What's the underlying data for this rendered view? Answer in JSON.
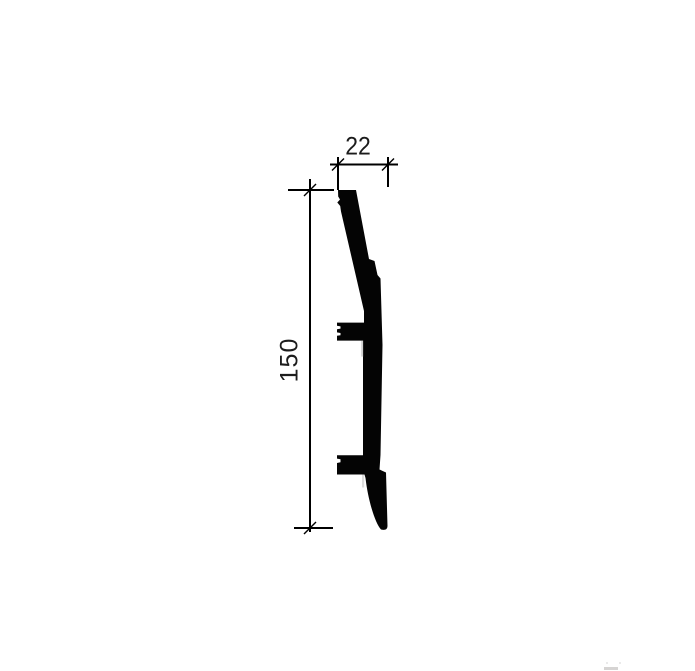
{
  "drawing": {
    "background_color": "#ffffff",
    "ink_color": "#000000",
    "profile_fill_color": "#040404",
    "shadow_color": "#9a9a9a",
    "watermark_color": "#b5b2b0",
    "width_dimension": {
      "label": "22"
    },
    "height_dimension": {
      "label": "150"
    }
  }
}
